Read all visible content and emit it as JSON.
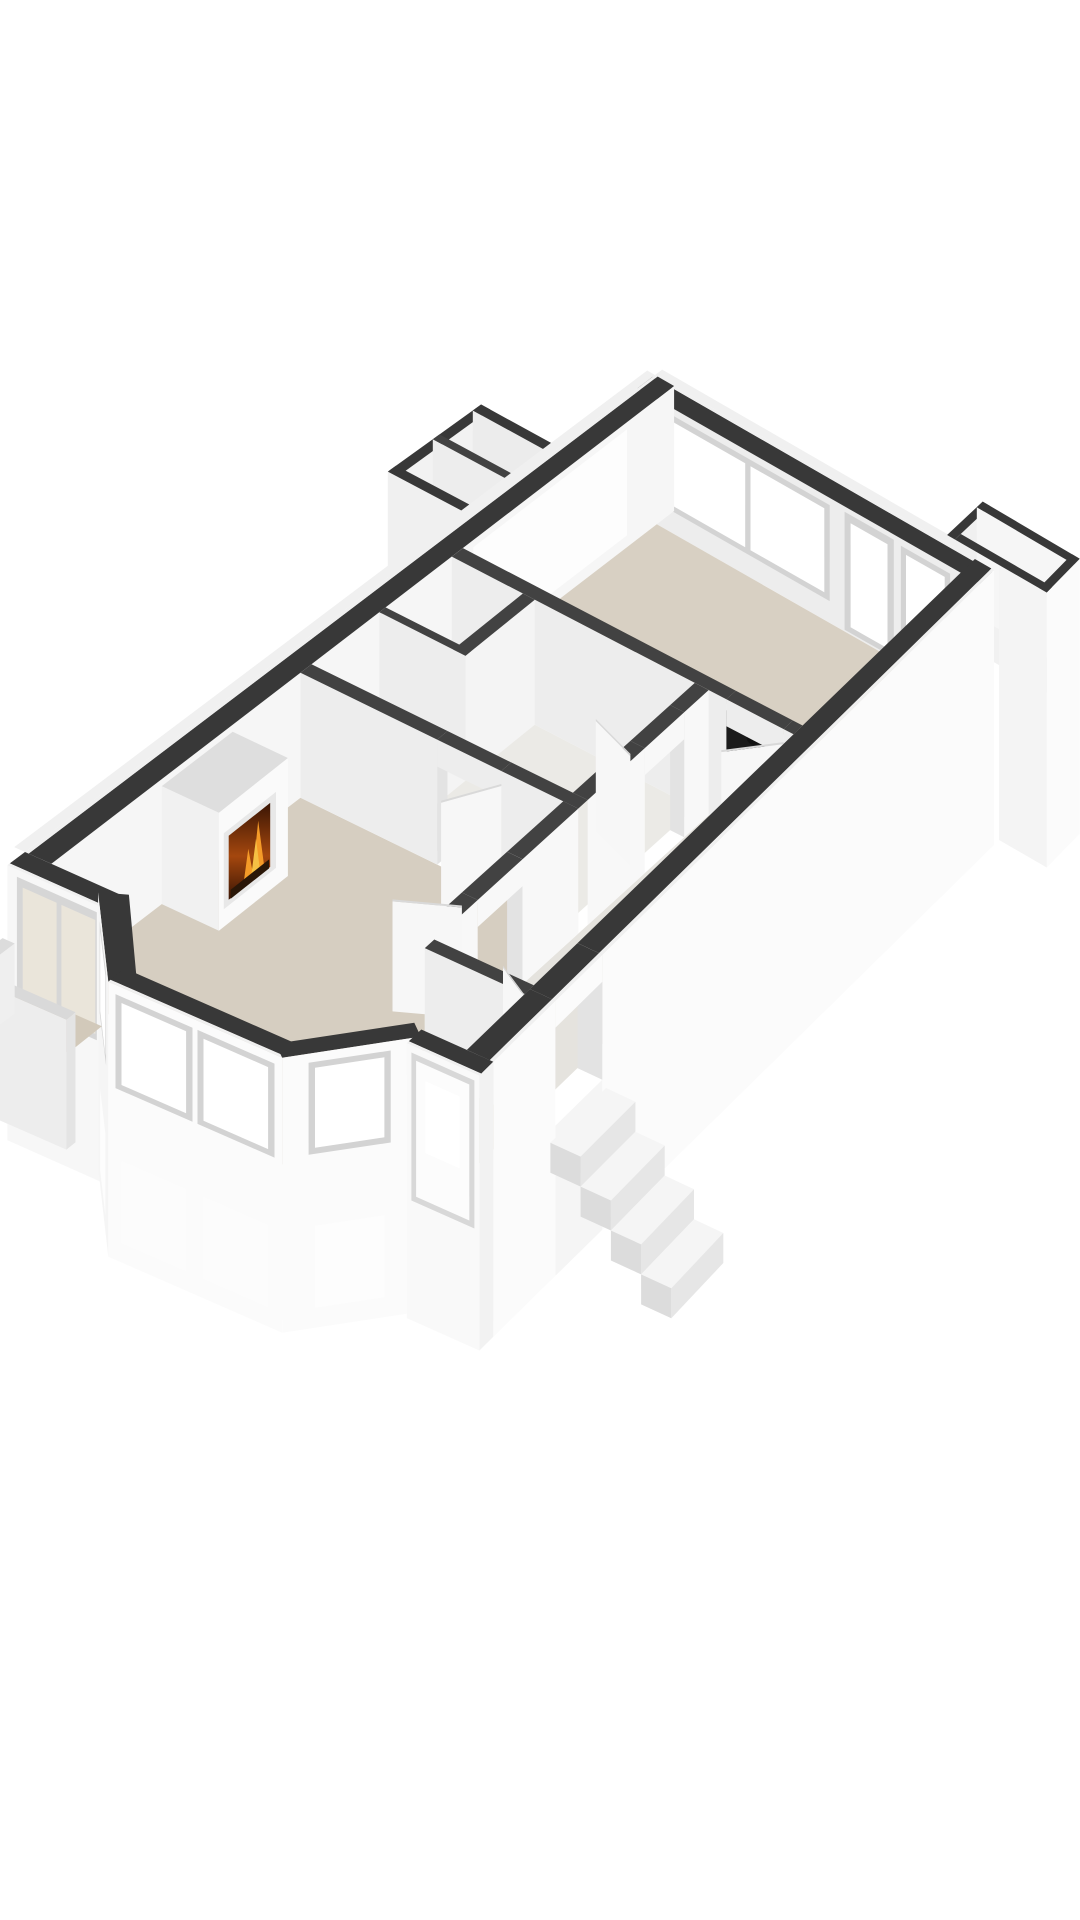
{
  "image": {
    "type": "3d-floorplan-cutaway-render",
    "view": "isometric-birdseye-from-south-east",
    "background": "#ffffff"
  },
  "colors": {
    "wallTop": "#383838",
    "wallTopIn": "#424242",
    "lip": "#f0f0f0",
    "extFace": "#fbfbfb",
    "extFace2": "#f6f6f6",
    "inFaceSW": "#ededed",
    "inFaceSE": "#f8f8f8",
    "reveal": "#e3e3e3",
    "frame": "#d3d3d3",
    "glass": "#ffffff",
    "glassTint": "#eae5da",
    "panel": "#fdfdfd",
    "floorKitchen": "#d8d0c3",
    "floorLiving": "#d6cec1",
    "floorHall": "#e5e3de",
    "floorBath": "#ebeae6",
    "floorCloset": "#f0efec",
    "floorTerrace": "#d2c9ba",
    "floorBalcony": "#f1f1f1",
    "floorShaft": "#e9e9e9",
    "counterTop": "#fbfbfb",
    "counterSide": "#efefef",
    "cooktop": "#1b1b1b",
    "burnerFill": "#111111",
    "burnerRing": "#6f6f6f",
    "burnerDot": "#aaaaaa",
    "knob": "#d8d8d8",
    "doorLeaf": "#f7f7f7",
    "doorEdge": "#d9d9d9",
    "stepTop": "#f5f5f5",
    "stepFront": "#e6e6e6",
    "stepSide": "#dcdcdc",
    "chimTop": "#dedede",
    "chimFace": "#fafafa",
    "chimEnd": "#f1f1f1",
    "surround": "#e8e8e8",
    "fireDark": "#3a1504",
    "fireMid": "#a4470e",
    "fireBright": "#e88a1f",
    "flame": "#f6c044",
    "flame2": "#f59b28",
    "log": "#2a1708",
    "mark": "#9a9a9a"
  },
  "rooms": [
    {
      "name": "living-room",
      "floor_color": "#d6cec1",
      "features": [
        "fireplace",
        "bay-window",
        "french-doors"
      ]
    },
    {
      "name": "kitchen-dining-room",
      "floor_color": "#d8d0c3",
      "features": [
        "kitchen-counter",
        "gas-cooktop",
        "balcony-door",
        "window-band"
      ]
    },
    {
      "name": "hallway",
      "floor_color": "#e5e3de",
      "features": [
        "entrance-door",
        "interior-doors"
      ]
    },
    {
      "name": "bathroom",
      "floor_color": "#ebeae6",
      "features": [
        "door"
      ]
    },
    {
      "name": "closets",
      "floor_color": "#f0efec",
      "features": []
    },
    {
      "name": "balcony",
      "floor_color": "#f1f1f1",
      "features": [
        "parapet-walls"
      ]
    },
    {
      "name": "terrace",
      "floor_color": "#d2c9ba",
      "features": [
        "parapet-walls"
      ]
    },
    {
      "name": "light-shaft",
      "floor_color": "#e9e9e9",
      "features": []
    }
  ],
  "features": {
    "cooktop_burners": 4,
    "cooktop_knobs": 4,
    "entrance_steps": 4,
    "bay_window_panes": 2,
    "bay_side_panes": 2,
    "kitchen_wall_openings": 3,
    "french_door_leaves": 2,
    "interior_door_leaves": 5
  }
}
